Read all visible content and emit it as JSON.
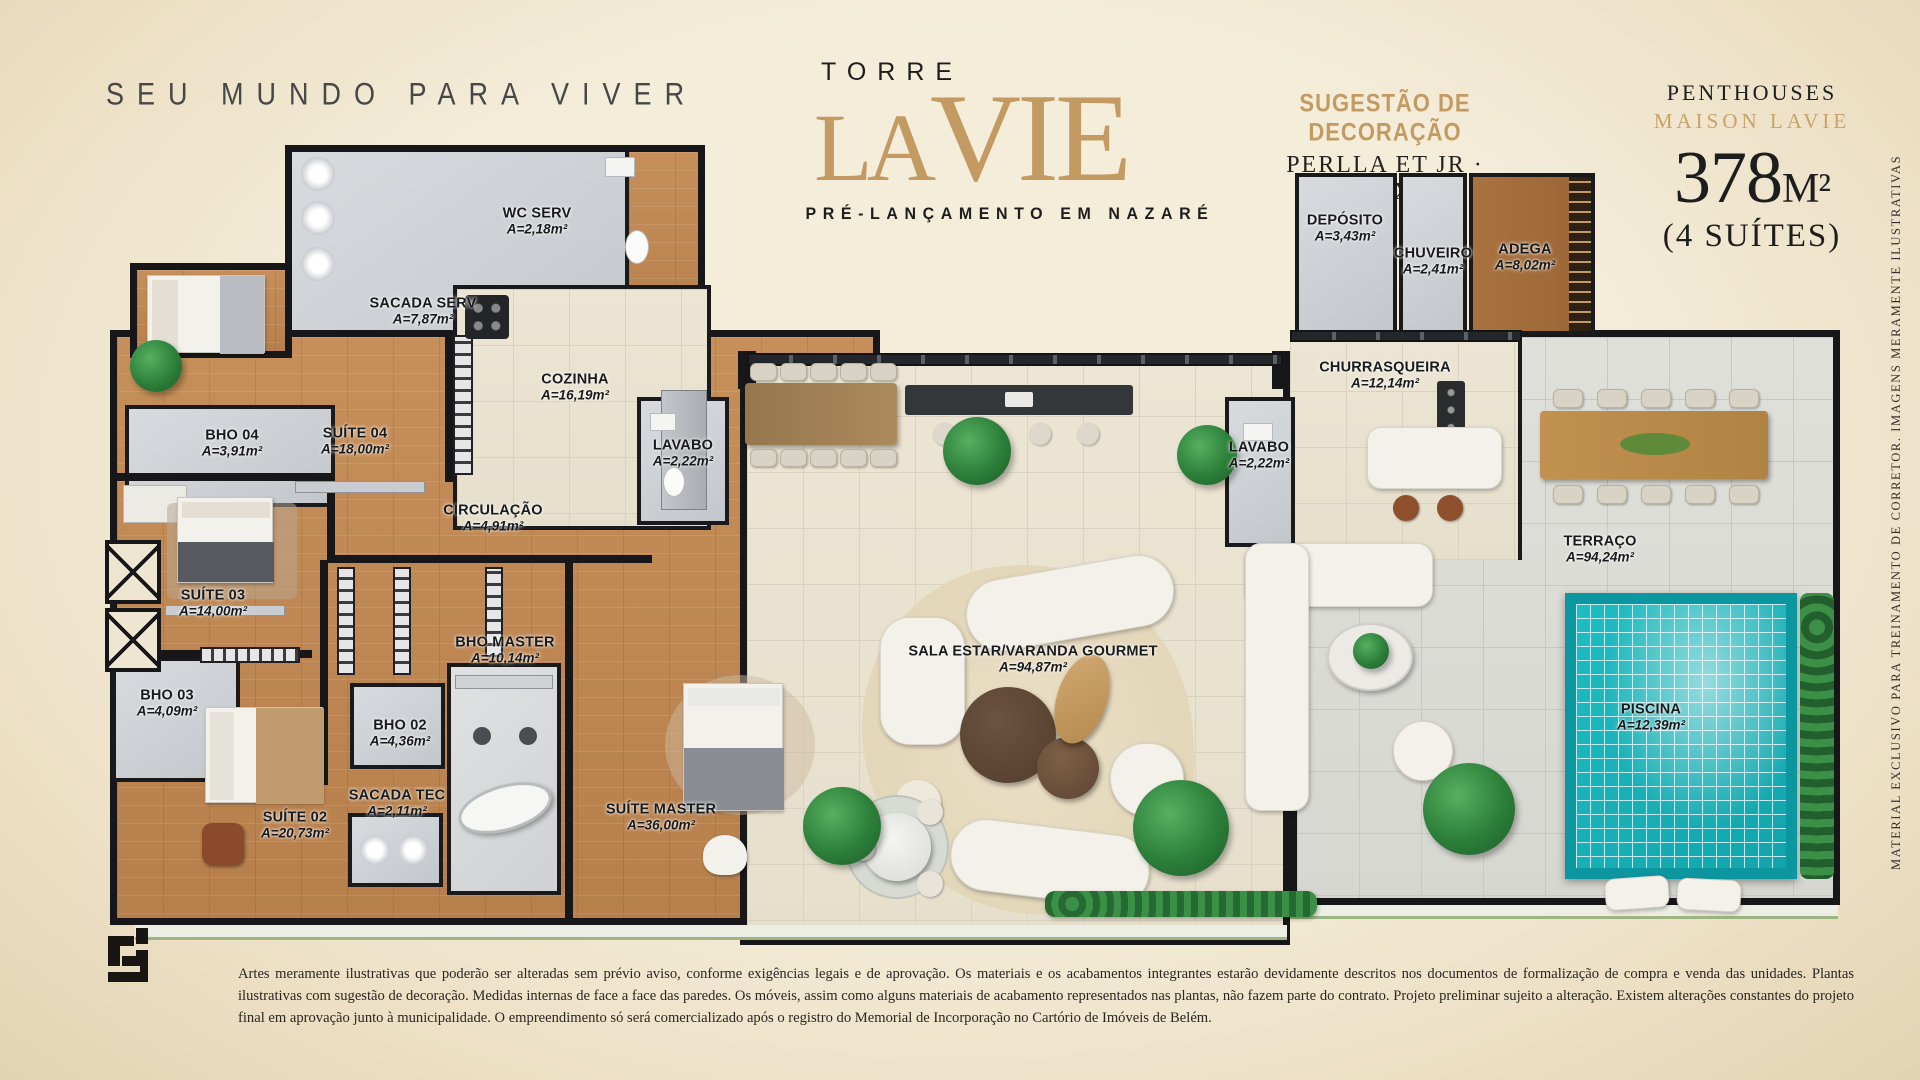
{
  "header": {
    "tagline": "SEU MUNDO PARA VIVER",
    "logo": {
      "torre": "TORRE",
      "la": "LA",
      "vie": "VIE",
      "subtitle": "PRÉ-LANÇAMENTO EM NAZARÉ"
    },
    "decoration": {
      "line1": "SUGESTÃO DE DECORAÇÃO",
      "line2": "PERLLA ET JR · DLX"
    },
    "unit": {
      "type": "PENTHOUSES",
      "brand": "MAISON LAVIE",
      "area_number": "378",
      "area_unit": "M²",
      "suites": "(4 SUÍTES)"
    }
  },
  "rooms": [
    {
      "name": "WC SERV",
      "area": "A=2,18m²"
    },
    {
      "name": "SACADA SERV",
      "area": "A=7,87m²"
    },
    {
      "name": "COZINHA",
      "area": "A=16,19m²"
    },
    {
      "name": "LAVABO",
      "area": "A=2,22m²"
    },
    {
      "name": "BHO 04",
      "area": "A=3,91m²"
    },
    {
      "name": "SUÍTE 04",
      "area": "A=18,00m²"
    },
    {
      "name": "CIRCULAÇÃO",
      "area": "A=4,91m²"
    },
    {
      "name": "SUÍTE 03",
      "area": "A=14,00m²"
    },
    {
      "name": "BHO 03",
      "area": "A=4,09m²"
    },
    {
      "name": "SUÍTE 02",
      "area": "A=20,73m²"
    },
    {
      "name": "BHO 02",
      "area": "A=4,36m²"
    },
    {
      "name": "SACADA TEC",
      "area": "A=2,11m²"
    },
    {
      "name": "BHO MASTER",
      "area": "A=10,14m²"
    },
    {
      "name": "SUÍTE MASTER",
      "area": "A=36,00m²"
    },
    {
      "name": "SALA ESTAR/VARANDA GOURMET",
      "area": "A=94,87m²"
    },
    {
      "name": "DEPÓSITO",
      "area": "A=3,43m²"
    },
    {
      "name": "CHUVEIRO",
      "area": "A=2,41m²"
    },
    {
      "name": "ADEGA",
      "area": "A=8,02m²"
    },
    {
      "name": "CHURRASQUEIRA",
      "area": "A=12,14m²"
    },
    {
      "name": "LAVABO",
      "area": "A=2,22m²"
    },
    {
      "name": "TERRAÇO",
      "area": "A=94,24m²"
    },
    {
      "name": "PISCINA",
      "area": "A=12,39m²"
    }
  ],
  "side_note": "MATERIAL EXCLUSIVO PARA TREINAMENTO DE CORRETOR.  IMAGENS MERAMENTE ILUSTRATIVAS",
  "footer": {
    "disclaimer": "Artes meramente ilustrativas que poderão ser alteradas sem prévio aviso, conforme exigências legais e de aprovação. Os materiais e os acabamentos integrantes estarão devidamente descritos nos documentos de formalização de compra e venda das unidades. Plantas ilustrativas com sugestão de decoração. Medidas internas de face a face das paredes. Os móveis, assim como alguns materiais de acabamento representados nas plantas, não fazem parte do contrato. Projeto preliminar sujeito a alteração. Existem alterações constantes do projeto final em aprovação junto à municipalidade. O empreendimento só será comercializado após o registro do Memorial de Incorporação no Cartório de Imóveis de Belém."
  },
  "colors": {
    "accent_gold": "#c49a63",
    "wall": "#17171a",
    "pool": "#12a4ac",
    "background": "#f2ead7"
  }
}
